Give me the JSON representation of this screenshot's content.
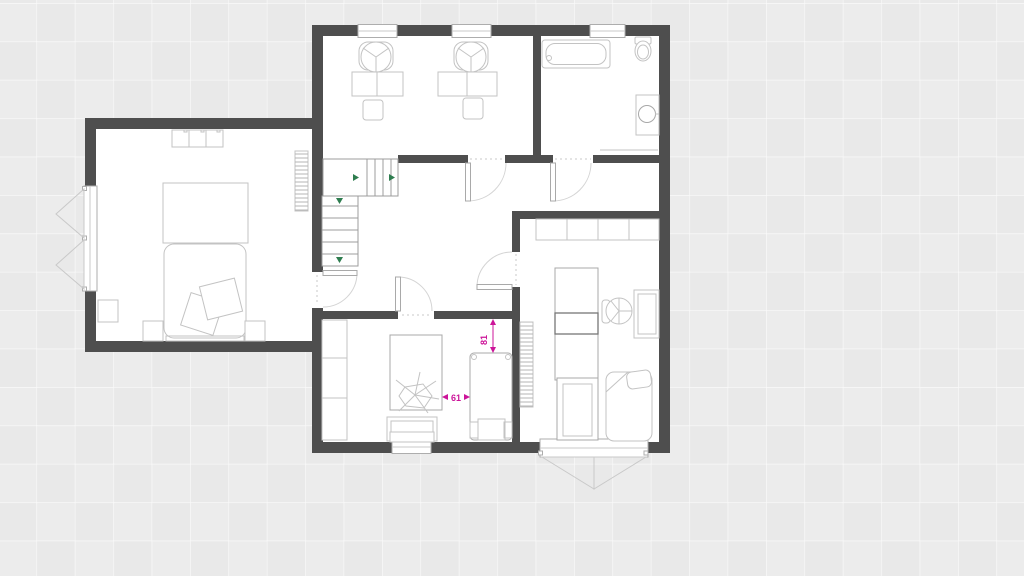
{
  "plan": {
    "dimension_labels": {
      "horizontal_gap": "61",
      "vertical_gap": "81"
    },
    "colors": {
      "background": "#e9e9e9",
      "grid_line": "#ffffff",
      "wall": "#4e4e4e",
      "floor": "#ffffff",
      "furniture_outline": "#c3c3c3",
      "stair_outline": "#9c9c9c",
      "stair_arrow": "#2e7d4f",
      "dimension_label": "#cc1499"
    }
  }
}
